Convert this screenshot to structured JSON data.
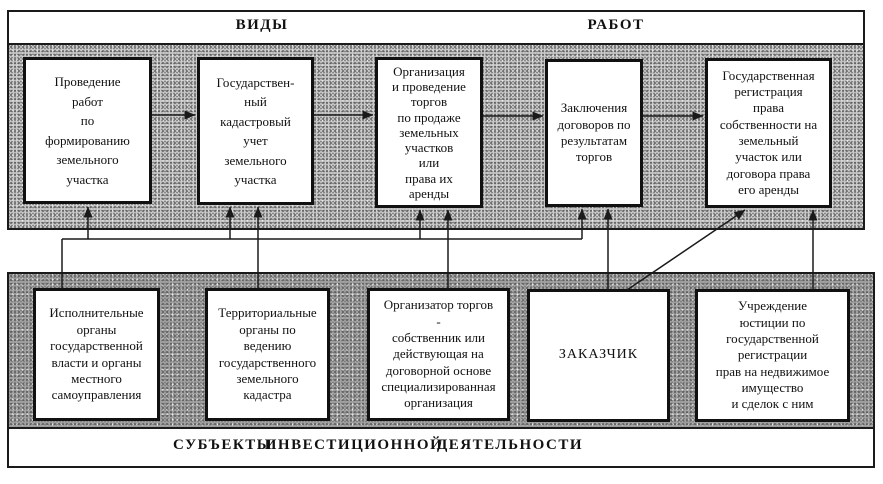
{
  "colors": {
    "line": "#1a1a1a",
    "band_top": "#c8c8c8",
    "band_bottom": "#a2a2a2",
    "box_bg": "#ffffff",
    "box_border": "#111111"
  },
  "header": {
    "left": "ВИДЫ",
    "right": "РАБОТ"
  },
  "works": [
    {
      "label": "Проведение\nработ\nпо\nформированию\nземельного\nучастка"
    },
    {
      "label": "Государствен-\nный\nкадастровый\nучет\nземельного\nучастка"
    },
    {
      "label": "Организация\nи проведение\nторгов\nпо продаже\nземельных\nучастков\nили\nправа их\nаренды"
    },
    {
      "label": "Заключения\nдоговоров по\nрезультатам\nторгов"
    },
    {
      "label": "Государственная\nрегистрация\nправа\nсобственности на\nземельный\nучасток или\nдоговора права\nего аренды"
    }
  ],
  "subjects": [
    {
      "label": "Исполнительные\nорганы\nгосударственной\nвласти и органы\nместного\nсамоуправления"
    },
    {
      "label": "Территориальные\nорганы по\nведению\nгосударственного\nземельного\nкадастра"
    },
    {
      "label": "Организатор торгов\n-\nсобственник или\nдействующая на\nдоговорной основе\nспециализированная\nорганизация"
    },
    {
      "label": "ЗАКАЗЧИК"
    },
    {
      "label": "Учреждение\nюстиции по\nгосударственной\nрегистрации\nправ на недвижимое\nимущество\nи сделок с ним"
    }
  ],
  "footer": {
    "word1": "СУБЪЕКТЫ",
    "word2": "ИНВЕСТИЦИОННОЙ",
    "word3": "ДЕЯТЕЛЬНОСТИ"
  }
}
